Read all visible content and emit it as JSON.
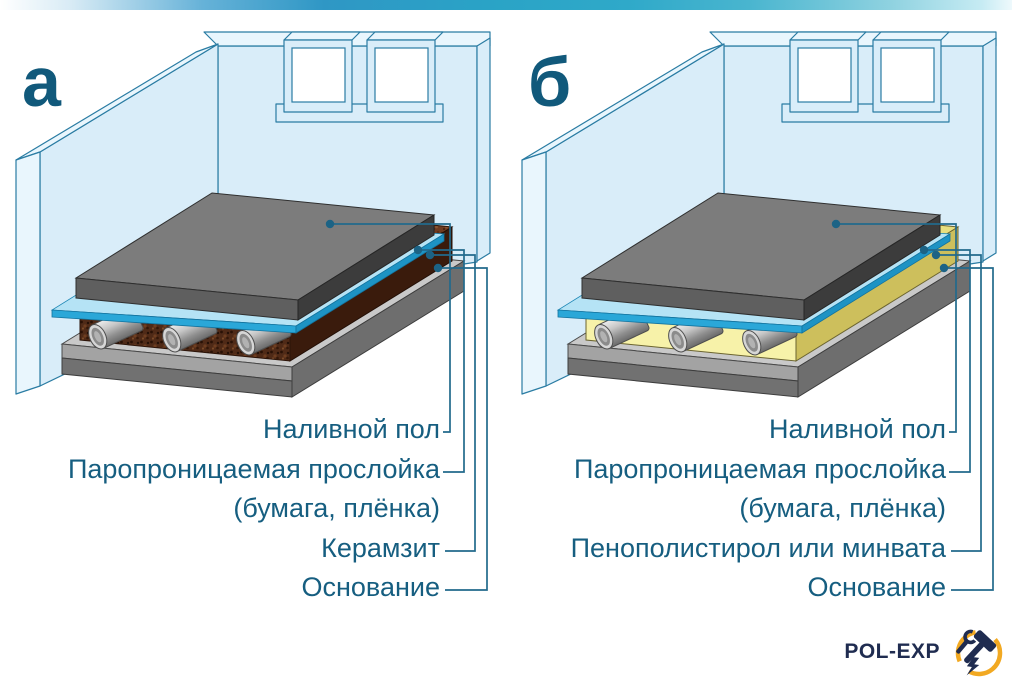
{
  "panels": [
    {
      "letter": "а",
      "labels": {
        "layer1": "Наливной пол",
        "layer2": "Паропроницаемая прослойка",
        "layer2b": "(бумага, плёнка)",
        "layer3": "Керамзит",
        "layer4": "Основание"
      }
    },
    {
      "letter": "б",
      "labels": {
        "layer1": "Наливной пол",
        "layer2": "Паропроницаемая прослойка",
        "layer2b": "(бумага, плёнка)",
        "layer3": "Пенополистирол или минвата",
        "layer4": "Основание"
      }
    }
  ],
  "logo": {
    "text": "POL-EXP"
  },
  "colors": {
    "label_text": "#165e80",
    "leader_line": "#226a8c",
    "accent_bar": "#2aa5c6",
    "wall_blue": "#d9edf9",
    "screed_gray": "#7c7c7c",
    "film_blue": "#2aa7d8",
    "insulation_a_brown": "#4f2a17",
    "insulation_b_yellow": "#f7f2a9",
    "logo_navy": "#1f2c50",
    "logo_gold": "#f2a922"
  }
}
